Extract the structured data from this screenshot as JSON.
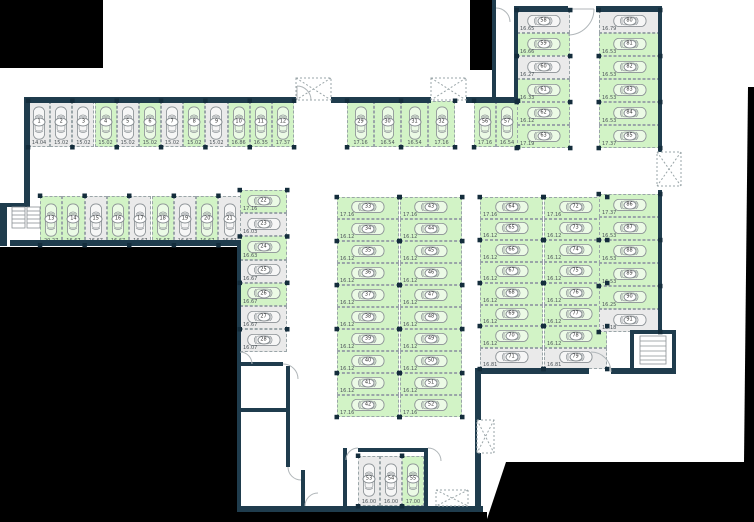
{
  "plan": {
    "type": "parking-garage-floor-plan",
    "status_colors": {
      "available": "#d2f3c6",
      "taken": "#eaeaea"
    },
    "wall_color": "#1f3c4d",
    "outside_color": "#000000",
    "icons": {
      "car": "top-view car outline",
      "vent_shaft": "dashed box with X cross",
      "stairs": "ladder rungs",
      "door": "quarter-circle swing arc",
      "pillar": "small dark square"
    },
    "sections": {
      "row_1_12": {
        "spaces": [
          {
            "num": "1",
            "size": "14.04",
            "status": "taken"
          },
          {
            "num": "2",
            "size": "15.02",
            "status": "taken"
          },
          {
            "num": "3",
            "size": "15.02",
            "status": "taken"
          },
          {
            "num": "4",
            "size": "15.02",
            "status": "available"
          },
          {
            "num": "5",
            "size": "15.02",
            "status": "taken"
          },
          {
            "num": "6",
            "size": "15.02",
            "status": "available"
          },
          {
            "num": "7",
            "size": "15.02",
            "status": "taken"
          },
          {
            "num": "8",
            "size": "15.02",
            "status": "available"
          },
          {
            "num": "9",
            "size": "15.02",
            "status": "taken"
          },
          {
            "num": "10",
            "size": "16.86",
            "status": "available"
          },
          {
            "num": "11",
            "size": "16.35",
            "status": "available"
          },
          {
            "num": "12",
            "size": "17.37",
            "status": "available"
          }
        ]
      },
      "row_13_21": {
        "spaces": [
          {
            "num": "13",
            "size": "20.27",
            "status": "available"
          },
          {
            "num": "14",
            "size": "16.67",
            "status": "available"
          },
          {
            "num": "15",
            "size": "16.67",
            "status": "taken"
          },
          {
            "num": "16",
            "size": "16.67",
            "status": "available"
          },
          {
            "num": "17",
            "size": "16.67",
            "status": "taken"
          },
          {
            "num": "18",
            "size": "16.67",
            "status": "available"
          },
          {
            "num": "19",
            "size": "16.67",
            "status": "taken"
          },
          {
            "num": "20",
            "size": "16.67",
            "status": "available"
          },
          {
            "num": "21",
            "size": "16.67",
            "status": "taken"
          }
        ]
      },
      "col_22_28": {
        "spaces": [
          {
            "num": "22",
            "size": "17.16",
            "status": "available"
          },
          {
            "num": "23",
            "size": "16.03",
            "status": "taken"
          },
          {
            "num": "24",
            "size": "16.63",
            "status": "available"
          },
          {
            "num": "25",
            "size": "16.67",
            "status": "taken"
          },
          {
            "num": "26",
            "size": "16.67",
            "status": "available"
          },
          {
            "num": "27",
            "size": "16.67",
            "status": "taken"
          },
          {
            "num": "28",
            "size": "16.07",
            "status": "taken"
          }
        ]
      },
      "row_29_32": {
        "spaces": [
          {
            "num": "29",
            "size": "17.16",
            "status": "available"
          },
          {
            "num": "30",
            "size": "16.54",
            "status": "available"
          },
          {
            "num": "31",
            "size": "16.54",
            "status": "available"
          },
          {
            "num": "32",
            "size": "17.16",
            "status": "available"
          }
        ]
      },
      "col_33_42": {
        "spaces": [
          {
            "num": "33",
            "size": "17.16",
            "status": "available"
          },
          {
            "num": "34",
            "size": "16.12",
            "status": "available"
          },
          {
            "num": "35",
            "size": "16.12",
            "status": "available"
          },
          {
            "num": "36",
            "size": "16.12",
            "status": "available"
          },
          {
            "num": "37",
            "size": "16.12",
            "status": "available"
          },
          {
            "num": "38",
            "size": "16.12",
            "status": "available"
          },
          {
            "num": "39",
            "size": "16.12",
            "status": "available"
          },
          {
            "num": "40",
            "size": "16.12",
            "status": "available"
          },
          {
            "num": "41",
            "size": "16.12",
            "status": "available"
          },
          {
            "num": "42",
            "size": "17.16",
            "status": "available"
          }
        ]
      },
      "col_43_52": {
        "spaces": [
          {
            "num": "43",
            "size": "17.16",
            "status": "available"
          },
          {
            "num": "44",
            "size": "16.12",
            "status": "available"
          },
          {
            "num": "45",
            "size": "16.12",
            "status": "available"
          },
          {
            "num": "46",
            "size": "16.12",
            "status": "available"
          },
          {
            "num": "47",
            "size": "16.12",
            "status": "available"
          },
          {
            "num": "48",
            "size": "16.12",
            "status": "available"
          },
          {
            "num": "49",
            "size": "16.12",
            "status": "available"
          },
          {
            "num": "50",
            "size": "16.12",
            "status": "available"
          },
          {
            "num": "51",
            "size": "16.12",
            "status": "available"
          },
          {
            "num": "52",
            "size": "17.16",
            "status": "available"
          }
        ]
      },
      "row_53_55": {
        "spaces": [
          {
            "num": "53",
            "size": "16.00",
            "status": "taken"
          },
          {
            "num": "54",
            "size": "16.00",
            "status": "taken"
          },
          {
            "num": "55",
            "size": "17.00",
            "status": "available"
          }
        ]
      },
      "row_56_57": {
        "spaces": [
          {
            "num": "56",
            "size": "17.16",
            "status": "available"
          },
          {
            "num": "57",
            "size": "16.54",
            "status": "available"
          }
        ]
      },
      "col_58_63": {
        "spaces": [
          {
            "num": "58",
            "size": "16.65",
            "status": "taken"
          },
          {
            "num": "59",
            "size": "16.66",
            "status": "available"
          },
          {
            "num": "60",
            "size": "16.27",
            "status": "taken"
          },
          {
            "num": "61",
            "size": "16.33",
            "status": "available"
          },
          {
            "num": "62",
            "size": "16.12",
            "status": "available"
          },
          {
            "num": "63",
            "size": "17.19",
            "status": "available"
          }
        ]
      },
      "col_64_71": {
        "spaces": [
          {
            "num": "64",
            "size": "17.16",
            "status": "available"
          },
          {
            "num": "65",
            "size": "16.12",
            "status": "available"
          },
          {
            "num": "66",
            "size": "16.12",
            "status": "available"
          },
          {
            "num": "67",
            "size": "16.12",
            "status": "available"
          },
          {
            "num": "68",
            "size": "16.12",
            "status": "available"
          },
          {
            "num": "69",
            "size": "16.12",
            "status": "available"
          },
          {
            "num": "70",
            "size": "16.12",
            "status": "available"
          },
          {
            "num": "71",
            "size": "16.81",
            "status": "taken"
          }
        ]
      },
      "col_72_79": {
        "spaces": [
          {
            "num": "72",
            "size": "17.16",
            "status": "available"
          },
          {
            "num": "73",
            "size": "16.12",
            "status": "available"
          },
          {
            "num": "74",
            "size": "16.12",
            "status": "available"
          },
          {
            "num": "75",
            "size": "16.12",
            "status": "available"
          },
          {
            "num": "76",
            "size": "16.12",
            "status": "available"
          },
          {
            "num": "77",
            "size": "16.12",
            "status": "available"
          },
          {
            "num": "78",
            "size": "16.12",
            "status": "available"
          },
          {
            "num": "79",
            "size": "16.81",
            "status": "taken"
          }
        ]
      },
      "col_80_85": {
        "spaces": [
          {
            "num": "80",
            "size": "16.79",
            "status": "taken"
          },
          {
            "num": "81",
            "size": "16.53",
            "status": "available"
          },
          {
            "num": "82",
            "size": "16.53",
            "status": "available"
          },
          {
            "num": "83",
            "size": "16.53",
            "status": "available"
          },
          {
            "num": "84",
            "size": "16.53",
            "status": "available"
          },
          {
            "num": "85",
            "size": "17.37",
            "status": "available"
          }
        ]
      },
      "col_86_91": {
        "spaces": [
          {
            "num": "86",
            "size": "17.37",
            "status": "available"
          },
          {
            "num": "87",
            "size": "16.53",
            "status": "available"
          },
          {
            "num": "88",
            "size": "16.53",
            "status": "available"
          },
          {
            "num": "89",
            "size": "16.53",
            "status": "available"
          },
          {
            "num": "90",
            "size": "16.25",
            "status": "available"
          },
          {
            "num": "91",
            "size": "16.18",
            "status": "taken"
          }
        ]
      }
    }
  }
}
